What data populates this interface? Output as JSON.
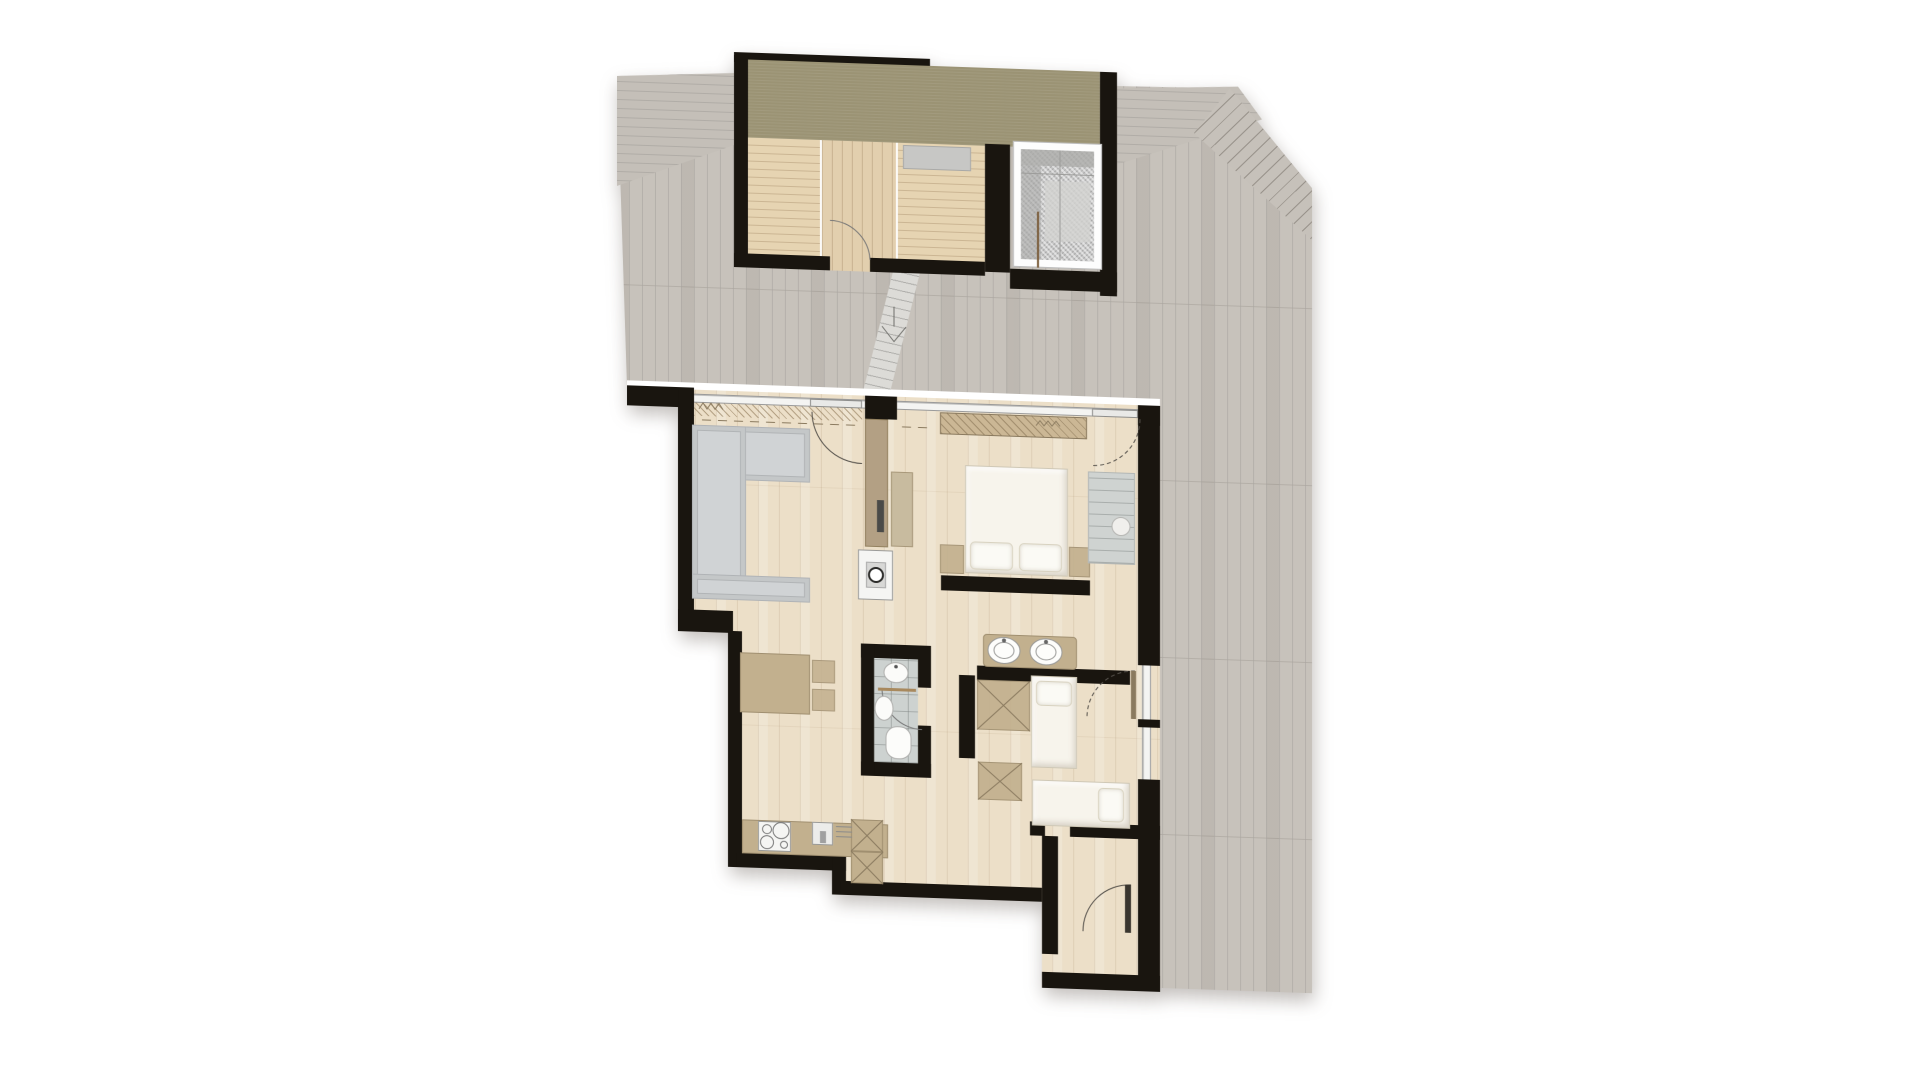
{
  "document": {
    "type": "architectural-floor-plan",
    "title": "Attic apartment floor plan with rooftop terrace, roof-access structure and skylight",
    "visible_text": [],
    "orientation_note": "plan rendered top-down with ~2 degree skew, soft drop shadow on white page"
  },
  "palette": {
    "--page-bg": "#ffffff",
    "--wall": "#19150f",
    "--terrace-wood": "#c7c2bb",
    "--roof-band": "#9b9374",
    "--indoor-wood": "#ecdfc8",
    "--warm-wood": "#e6d4b2",
    "--tile": "#cdd2d0",
    "--sofa": "#d0d3d5",
    "--sofa-line": "#b0b3b6",
    "--tan-furniture": "#c2b08e",
    "--tan-dark": "#a08f70",
    "--bed-white": "#f7f4ec",
    "--fixture-white": "#f5f5f3",
    "--glass": "#f4f4f2",
    "--stroke": "#55514b"
  },
  "areas": [
    {
      "id": "terrace",
      "label": "rooftop terrace, weathered gray decking (vertical, horizontal and diagonal plank fields)"
    },
    {
      "id": "roof-structure",
      "label": "roof access structure with olive flat-roof band, three small wood-floored rooms"
    },
    {
      "id": "skylight",
      "label": "glazed skylight over stairwell with handrail visible below"
    },
    {
      "id": "walkway",
      "label": "slatted gangway from structure door to apartment terrace door with direction chevron"
    },
    {
      "id": "living-room",
      "label": "living room with corner sofa and glazed terrace wall"
    },
    {
      "id": "kitchen-dining",
      "label": "kitchen row with cooktop, sink, tall cabinets and dining table with two chairs"
    },
    {
      "id": "wc",
      "label": "guest WC with washbasin, hand basin and wall-hung toilet on gray tiles"
    },
    {
      "id": "bedroom",
      "label": "main bedroom with double bed, headboard wall, nightstands and shelf wardrobe"
    },
    {
      "id": "vanity-zone",
      "label": "open bath zone with double washbasin counter"
    },
    {
      "id": "second-bedroom",
      "label": "second bedroom with two single beds and X-marked wardrobes"
    },
    {
      "id": "entry-hall",
      "label": "entry hall with entrance door swing at bottom-right"
    }
  ],
  "furniture": [
    "u-shaped-corner-sofa",
    "wood-stove",
    "tv-wardrobe-partition",
    "dining-table",
    "dining-chairs",
    "kitchen-counter",
    "cooktop-4-burners",
    "kitchen-sink",
    "tall-cabinet-x2",
    "double-bed",
    "pillows",
    "nightstand-x2",
    "shelf-wardrobe",
    "round-stool",
    "double-washbasin-counter",
    "single-bed-x2",
    "x-wardrobe-x2",
    "wc-washbasin",
    "wc-hand-basin",
    "wall-hung-toilet"
  ],
  "openings": [
    "living-room-terrace-door",
    "bedroom-terrace-door",
    "second-bedroom-terrace-door",
    "right-wall-window",
    "glazed-north-wall",
    "wc-door",
    "entry-door",
    "structure-room-door"
  ]
}
